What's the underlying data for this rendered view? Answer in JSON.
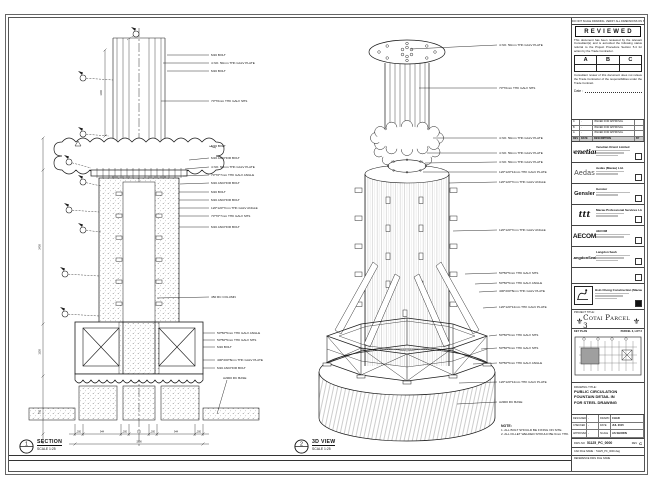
{
  "stamp": {
    "top_note": "DO NOT SCALE DRAWING. VERIFY ALL DIMENSIONS ON SITE.",
    "title": "REVIEWED",
    "body1": "This document has been reviewed by the relevant Consultant(s) and is accorded the following status referral to the Project Procedure Section 5.4 for action by the Trade Contractor.",
    "grades": [
      "A",
      "B",
      "C"
    ],
    "body2": "Consultant review of this document does not relieve the Trade Contractor of the responsibilities under the Trade Contract.",
    "date_label": "Date :"
  },
  "revisions": {
    "header": [
      "REV",
      "DATE",
      "DESCRIPTION",
      "BY"
    ],
    "rows": [
      [
        "C",
        "-",
        "ISSUED FOR APPROVAL",
        ""
      ],
      [
        "B",
        "-",
        "ISSUED FOR APPROVAL",
        ""
      ],
      [
        "A",
        "-",
        "ISSUED FOR APPROVAL",
        ""
      ]
    ]
  },
  "consultants": [
    {
      "logo": "venetian",
      "name": "Venetian Orient Limited"
    },
    {
      "logo": "Aedas",
      "name": "Aedas (Macau) Ltd."
    },
    {
      "logo": "Gensler",
      "name": "Gensler"
    },
    {
      "logo": "ttt",
      "name": "Macau Professional Services Ltd."
    },
    {
      "logo": "AECOM",
      "name": "AECOM"
    },
    {
      "logo": "LangdonSeah",
      "name": "Langdon Seah"
    }
  ],
  "contractor": {
    "name": "Hsin Chong Construction (Macau) Co., Ltd."
  },
  "project": {
    "label": "PROJECT TITLE:",
    "name": "Cotai Parcel 3",
    "emblem": "⚜"
  },
  "key_plan": {
    "label": "KEY PLAN",
    "sub": "PARCEL 3, LOT 2"
  },
  "title_block": {
    "drawing_title_label": "DRAWING TITLE:",
    "title_lines": [
      "PUBLIC CIRCULATION",
      "FOUNTAIN DETAIL IN",
      "FOR STEEL DRAWING"
    ],
    "fields": {
      "designed_label": "DESIGNED",
      "designed": "-",
      "drawn_label": "DRAWN",
      "drawn": "CHAD",
      "checked_label": "CHECKED",
      "checked": "-",
      "date_label": "DATE",
      "date": "JUL 2015",
      "approved_label": "APPROVED",
      "approved": "-",
      "scale_label": "SCALE",
      "scale": "AS SHOWN"
    },
    "dwg_no_label": "DWG NO",
    "dwg_no": "51125_PC_0000",
    "rev_label": "REV",
    "rev": "C",
    "cad_label": "CAD FILE NAME :",
    "cad_file": "51125_PC_0000.dwg",
    "ref_label": "REFERENCE DWG FILE NAME"
  },
  "views": {
    "section": {
      "num": "1",
      "title": "SECTION",
      "scale": "SCALE 1:25"
    },
    "iso": {
      "num": "2",
      "title": "3D VIEW",
      "scale": "SCALE 1:25"
    }
  },
  "notes": {
    "title": "NOTE:",
    "lines": [
      "1. ALL BOLT SHOULD BE FIXING ON SITE.",
      "2. ALL FILLET WELDED SHOULD BE 6mm THK."
    ]
  },
  "section_callouts": [
    "M16 BOLT",
    "4 NO. 50mm THK GALV PLATE",
    "M16 BOLT",
    "70*70mm THK GALV SHS",
    "M16 BOLT",
    "M16 ANCHOR BOLT",
    "4 NO. 50mm THK GALV PLATE",
    "70*70*7mm THK GALV ANGLE",
    "M16 ANCHOR BOLT",
    "M16 BOLT",
    "M16 ANCHOR BOLT",
    "120*120*7mm THK GALV ANGLE",
    "70*70*7mm THK GALV SHS",
    "M16 ANCHOR BOLT",
    "450 RC COLUMN",
    "50*50*5mm THK GALV ANGLE",
    "50*50*5mm THK GALV SHS",
    "M16 BOLT",
    "400*200*8mm THK GALV PLATE",
    "M16 ANCHOR BOLT",
    "A2900 RC BASE"
  ],
  "iso_callouts": [
    "4 NO. 50mm THK GALV PLATE",
    "70*70mm THK GALV SHS",
    "4 NO. 50mm THK GALV PLATE",
    "4 NO. 50mm THK GALV PLATE",
    "4 NO. 50mm THK GALV PLATE",
    "120*120*12mm THK GALV PLATE",
    "120*120*7mm THK GALV ANGLE",
    "120*120*7mm THK GALV ANGLE",
    "50*50*5mm THK GALV SHS",
    "50*50*5mm THK GALV ANGLE",
    "400*200*8mm THK GALV PLATE",
    "120*120*12mm THK GALV PLATE",
    "50*50*5mm THK GALV SHS",
    "50*50*5mm THK GALV SHS",
    "50*50*5mm THK GALV ANGLE",
    "120*120*12mm THK GALV PLATE",
    "A2900 RC BASE"
  ],
  "section_dims": {
    "column": "1200",
    "left": [
      "2400",
      "1500",
      "750"
    ],
    "bottom": [
      "200",
      "944",
      "200",
      "512",
      "200",
      "944",
      "200"
    ],
    "total": "3200"
  }
}
